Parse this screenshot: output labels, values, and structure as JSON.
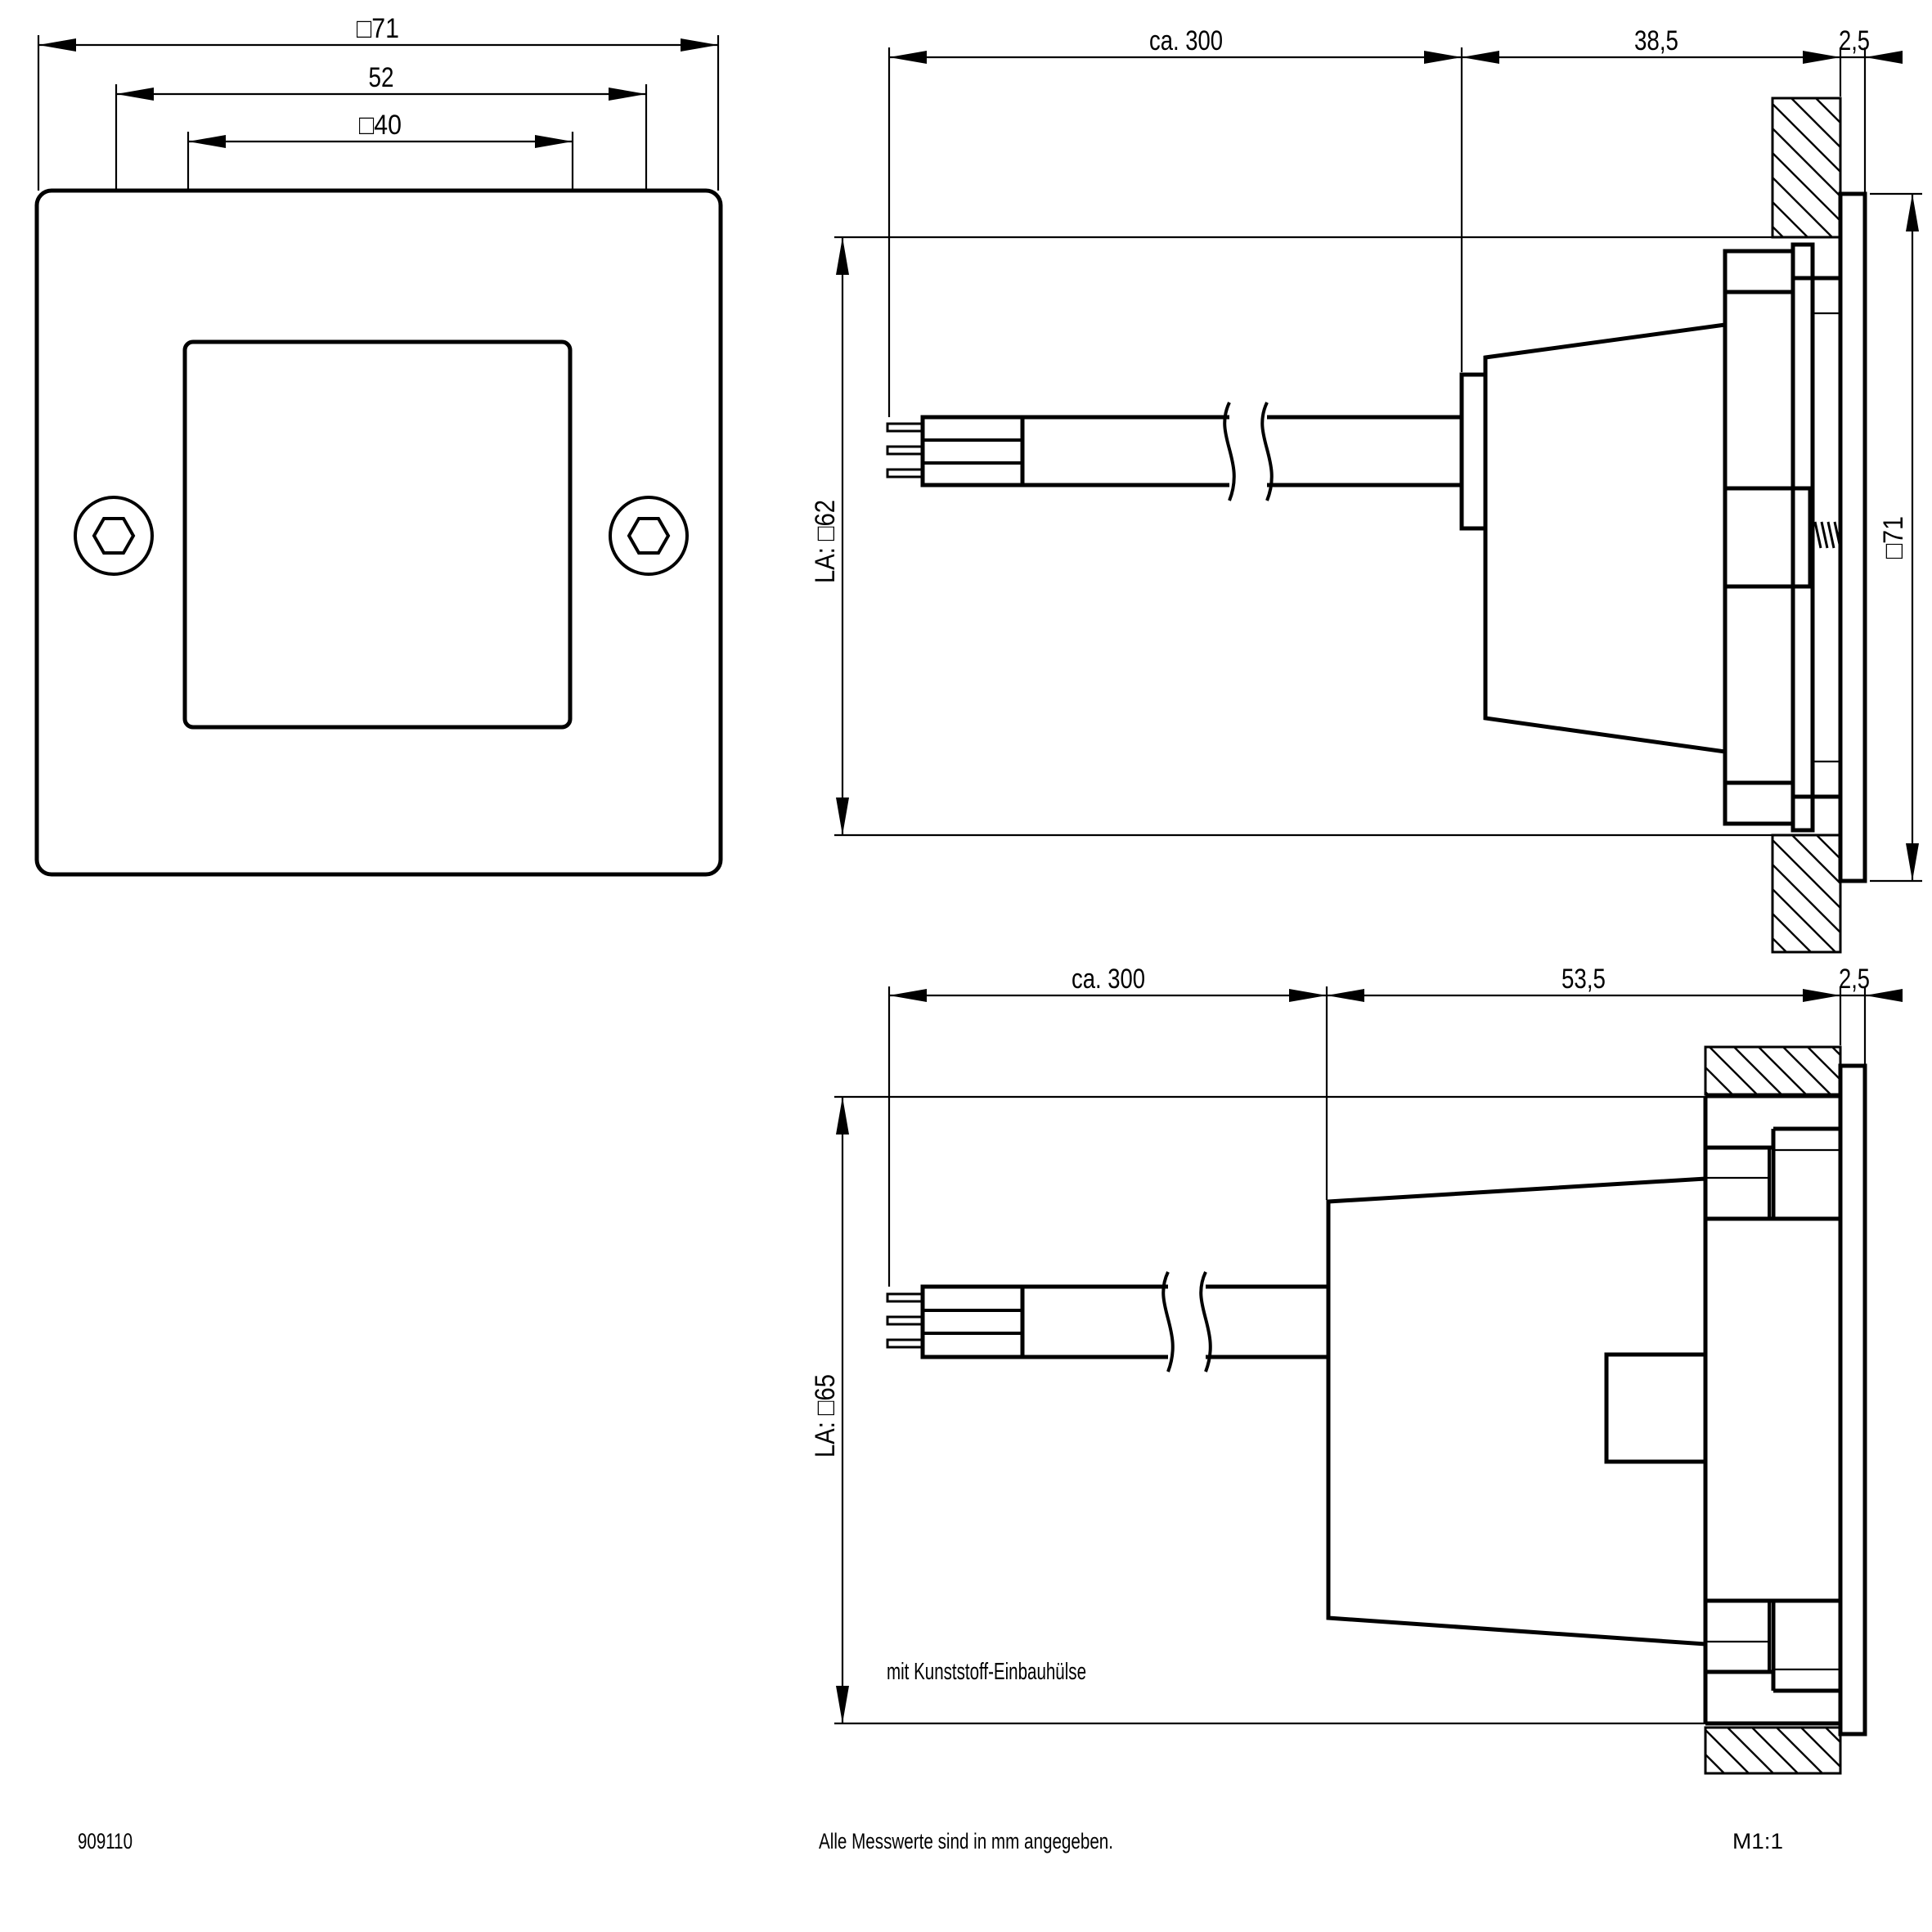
{
  "colors": {
    "line": "#000000",
    "background": "#ffffff"
  },
  "front_view": {
    "dim_outer": "□71",
    "dim_screw_spacing": "52",
    "dim_window": "□40"
  },
  "side_view_top": {
    "dim_cable": "ca. 300",
    "dim_depth": "38,5",
    "dim_plate": "2,5",
    "dim_cutout": "LA: □62",
    "dim_height": "□71"
  },
  "side_view_bottom": {
    "dim_cable": "ca. 300",
    "dim_depth": "53,5",
    "dim_plate": "2,5",
    "dim_cutout": "LA: □65",
    "note": "mit Kunststoff-Einbauhülse"
  },
  "footer": {
    "article_number": "909110",
    "units_note": "Alle Messwerte sind in mm angegeben.",
    "scale": "M1:1"
  }
}
